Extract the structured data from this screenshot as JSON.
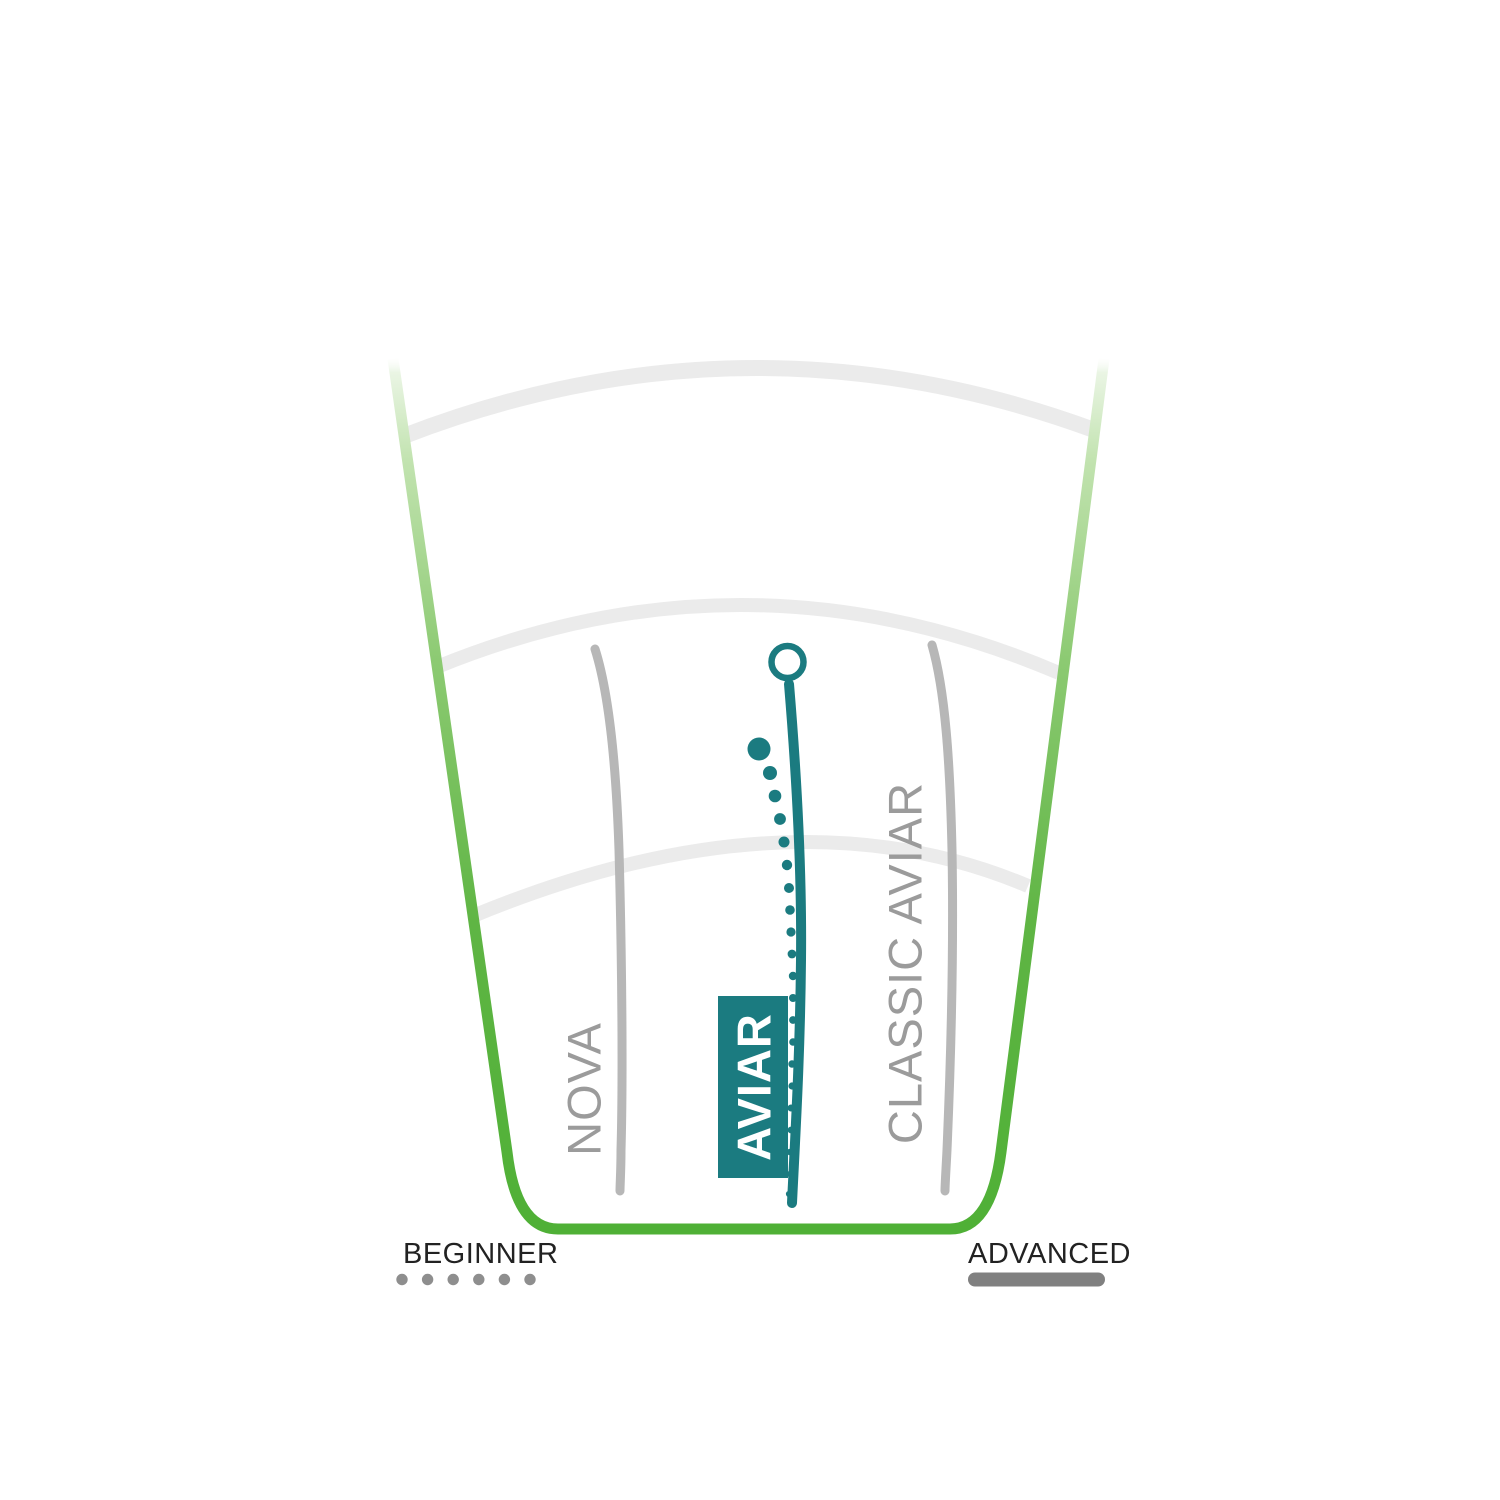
{
  "colors": {
    "background": "#ffffff",
    "fairway_green": "#4fb036",
    "fairway_green_light": "#c2e3b0",
    "teal": "#1b7b80",
    "flight_line_gray": "#b7b7b7",
    "label_gray": "#9b9b9b",
    "distance_ring_gray": "#ebebeb",
    "legend_text": "#222222",
    "legend_dot_gray": "#8e8e8e",
    "legend_bar_gray": "#808080",
    "badge_text": "#ffffff"
  },
  "labels": {
    "nova": "NOVA",
    "aviar": "AVIAR",
    "classic_aviar": "CLASSIC AVIAR"
  },
  "legend": {
    "beginner": "BEGINNER",
    "advanced": "ADVANCED"
  },
  "chart_data": {
    "type": "line",
    "title": "",
    "legend": [
      {
        "label": "BEGINNER",
        "marker": "dotted-line"
      },
      {
        "label": "ADVANCED",
        "marker": "solid-line"
      }
    ],
    "distance_rings_count": 3,
    "paths": {
      "ring_outer": "M 404 436 Q 748 303 1094 430",
      "ring_mid": "M 437 667 Q 748 540 1059 673",
      "ring_inner": "M 473 916 Q 790 785 1028 886",
      "fairway": "M 393 359 L 507 1152 Q 516 1229 558 1229 L 950 1229 Q 991 1229 1001 1152 L 1104 359",
      "nova": "M 595 649 C 608 690 616 760 619 850 C 622 960 623 1080 621 1150 C 621 1170 620 1185 620 1191",
      "classic": "M 932 645 C 945 690 950 760 952 850 C 954 960 950 1080 947 1150 C 946 1170 945 1185 945 1191",
      "aviar": "M 789 684 C 797 780 802 870 801 960 C 800 1060 795 1140 792 1203"
    },
    "series": [
      {
        "name": "NOVA",
        "color": "#b7b7b7",
        "style": "solid",
        "points_px": [
          [
            595,
            649
          ],
          [
            618,
            820
          ],
          [
            622,
            1000
          ],
          [
            620,
            1191
          ]
        ]
      },
      {
        "name": "AVIAR",
        "color": "#1b7b80",
        "style": "solid-highlighted",
        "end_marker": {
          "shape": "open-circle",
          "cx": 787.5,
          "cy": 662,
          "r": 16
        },
        "points_px": [
          [
            792,
            1203
          ],
          [
            801,
            980
          ],
          [
            797,
            780
          ],
          [
            789,
            684
          ]
        ],
        "fade_dots_px": [
          [
            759,
            749,
            11.5
          ],
          [
            770,
            773,
            7
          ],
          [
            775,
            796,
            6.3
          ],
          [
            780,
            819,
            5.9
          ],
          [
            784,
            842,
            5.5
          ],
          [
            787,
            865,
            5.2
          ],
          [
            789,
            888,
            5.0
          ],
          [
            790,
            910,
            4.8
          ],
          [
            791,
            932,
            4.6
          ],
          [
            792,
            954,
            4.4
          ],
          [
            793,
            976,
            4.2
          ],
          [
            793,
            998,
            4.0
          ],
          [
            793,
            1020,
            3.9
          ],
          [
            793,
            1042,
            3.8
          ],
          [
            792,
            1064,
            3.7
          ],
          [
            792,
            1086,
            3.6
          ],
          [
            791,
            1108,
            3.5
          ],
          [
            791,
            1130,
            3.4
          ],
          [
            790,
            1152,
            3.3
          ],
          [
            790,
            1174,
            3.2
          ],
          [
            789,
            1194,
            3.1
          ]
        ]
      },
      {
        "name": "CLASSIC AVIAR",
        "color": "#b7b7b7",
        "style": "solid",
        "points_px": [
          [
            932,
            645
          ],
          [
            952,
            850
          ],
          [
            948,
            1120
          ],
          [
            945,
            1191
          ]
        ]
      }
    ],
    "legend_marks": {
      "beginner_dots": {
        "count": 6,
        "start_x": 402,
        "y": 1279.5,
        "spacing": 25.6,
        "r": 5.7
      },
      "advanced_bar": {
        "x": 968,
        "y": 1272.5,
        "width": 137,
        "height": 14,
        "rx": 7
      }
    }
  }
}
